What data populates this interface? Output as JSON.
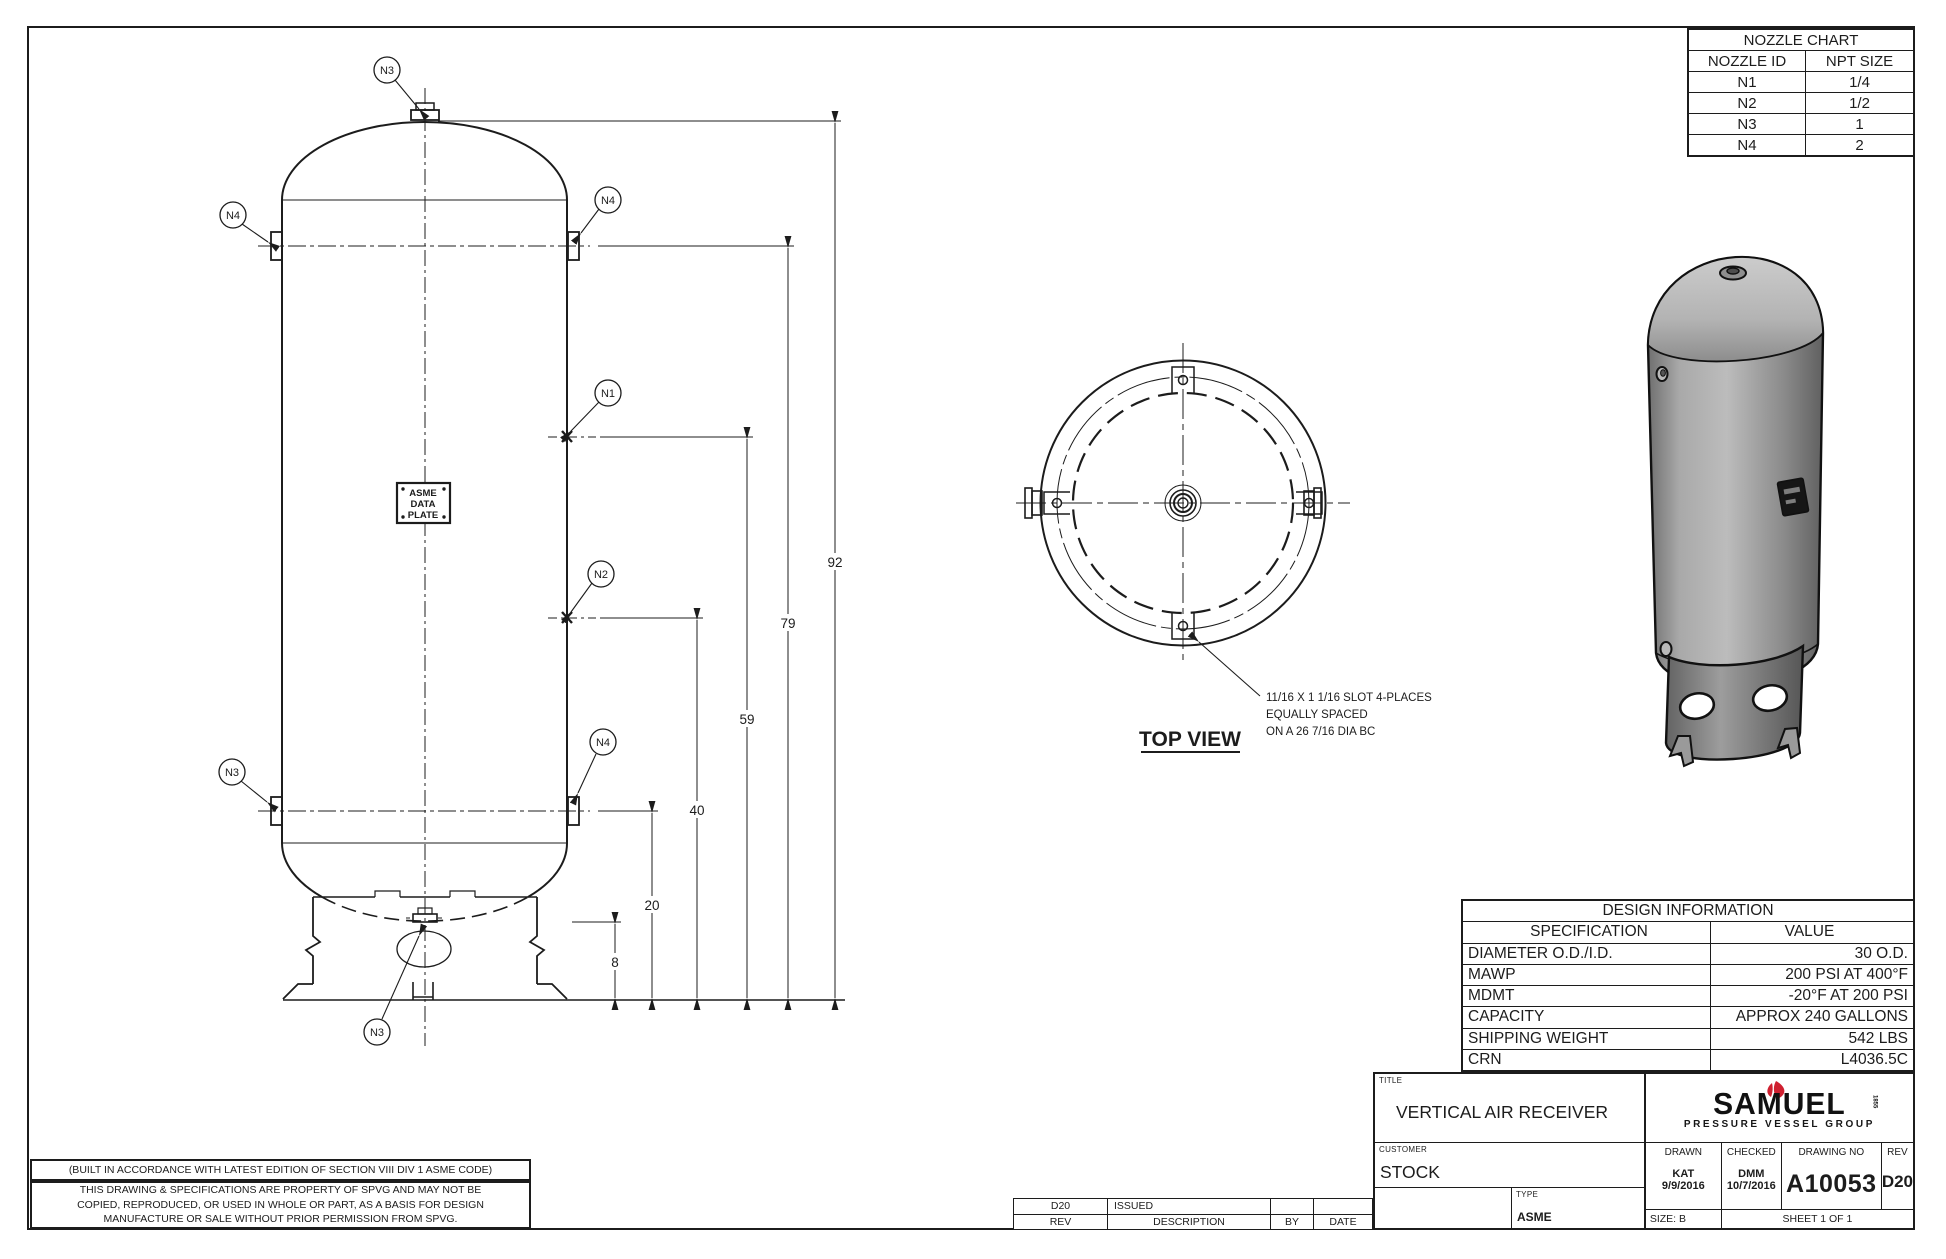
{
  "colors": {
    "line": "#1c1c1c",
    "logo_red": "#cf2030",
    "vessel_gray_light": "#c4c4c4",
    "vessel_gray_mid": "#9a9a9a",
    "vessel_gray_dark": "#636363"
  },
  "nozzle_chart": {
    "title": "NOZZLE CHART",
    "headers": {
      "id": "NOZZLE ID",
      "size": "NPT SIZE"
    },
    "rows": [
      {
        "id": "N1",
        "size": "1/4"
      },
      {
        "id": "N2",
        "size": "1/2"
      },
      {
        "id": "N3",
        "size": "1"
      },
      {
        "id": "N4",
        "size": "2"
      }
    ]
  },
  "design_info": {
    "title": "DESIGN INFORMATION",
    "headers": {
      "spec": "SPECIFICATION",
      "value": "VALUE"
    },
    "rows": [
      {
        "spec": "DIAMETER O.D./I.D.",
        "value": "30 O.D."
      },
      {
        "spec": "MAWP",
        "value": "200 PSI AT 400°F"
      },
      {
        "spec": "MDMT",
        "value": "-20°F AT 200 PSI"
      },
      {
        "spec": "CAPACITY",
        "value": "APPROX 240 GALLONS"
      },
      {
        "spec": "SHIPPING WEIGHT",
        "value": "542 LBS"
      },
      {
        "spec": "CRN",
        "value": "L4036.5C"
      }
    ]
  },
  "title_block": {
    "title_label": "TITLE",
    "title": "VERTICAL AIR RECEIVER",
    "customer_label": "CUSTOMER",
    "customer": "STOCK",
    "type_label": "TYPE",
    "type": "ASME",
    "drawn_label": "DRAWN",
    "drawn_by": "KAT",
    "drawn_date": "9/9/2016",
    "checked_label": "CHECKED",
    "checked_by": "DMM",
    "checked_date": "10/7/2016",
    "drawing_no_label": "DRAWING NO",
    "drawing_no": "A10053",
    "rev_label": "REV",
    "rev": "D20",
    "size_label": "SIZE: B",
    "sheet_label": "SHEET 1  OF 1"
  },
  "logo": {
    "name": "SAMUEL",
    "year": "1855",
    "subtitle": "PRESSURE VESSEL GROUP"
  },
  "revision": {
    "entry": {
      "rev": "D20",
      "description": "ISSUED",
      "by": "",
      "date": ""
    },
    "headers": {
      "rev": "REV",
      "description": "DESCRIPTION",
      "by": "BY",
      "date": "DATE"
    }
  },
  "notes": {
    "code_note": "(BUILT IN ACCORDANCE WITH LATEST EDITION OF SECTION VIII DIV 1 ASME CODE)",
    "property_lines": [
      "THIS DRAWING & SPECIFICATIONS ARE PROPERTY OF SPVG AND MAY NOT BE",
      "COPIED, REPRODUCED, OR USED IN WHOLE OR PART, AS A BASIS FOR DESIGN",
      "MANUFACTURE OR SALE WITHOUT PRIOR PERMISSION FROM SPVG."
    ]
  },
  "front_view": {
    "balloons": {
      "n1": "N1",
      "n2": "N2",
      "n3": "N3",
      "n4": "N4"
    },
    "plate_lines": [
      "ASME",
      "DATA",
      "PLATE"
    ],
    "dims": {
      "d92": "92",
      "d79": "79",
      "d59": "59",
      "d40": "40",
      "d20": "20",
      "d8": "8"
    }
  },
  "top_view": {
    "label": "TOP VIEW",
    "callout": [
      "11/16 X 1 1/16 SLOT 4-PLACES",
      "EQUALLY SPACED",
      "ON A 26 7/16 DIA BC"
    ]
  }
}
